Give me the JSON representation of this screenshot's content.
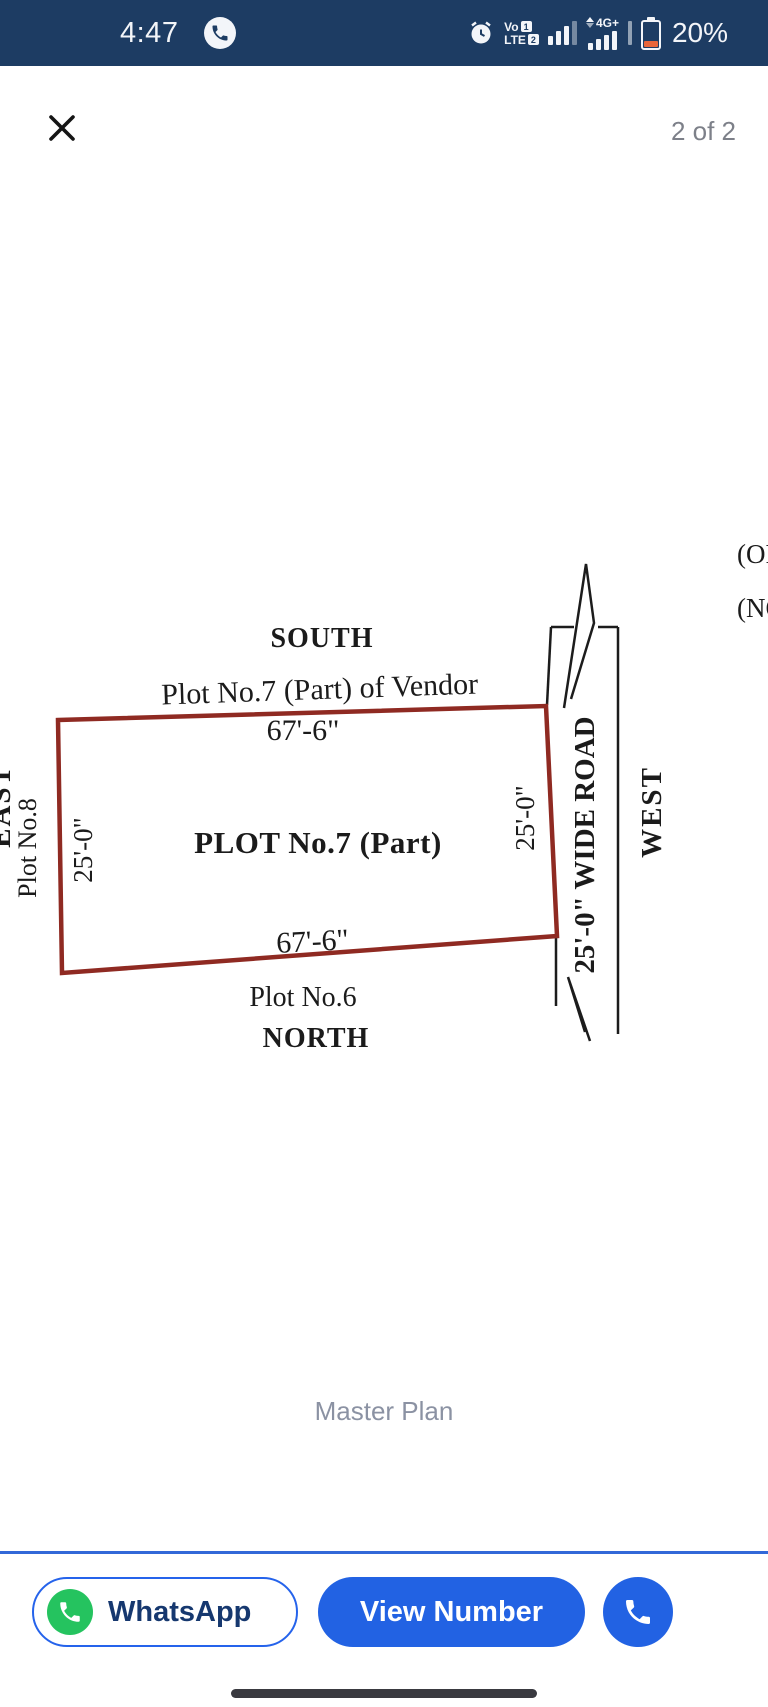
{
  "status_bar": {
    "time": "4:47",
    "battery_percent": "20%",
    "network": {
      "volte_top": "Vo",
      "volte_bottom": "LTE",
      "sim1": "1",
      "sim2": "2",
      "speed_label": "4G+"
    }
  },
  "viewer": {
    "page_indicator": "2 of 2",
    "caption": "Master Plan"
  },
  "diagram": {
    "direction_labels": {
      "south": "SOUTH",
      "north": "NORTH",
      "east": "EAST",
      "west": "WEST"
    },
    "plot": {
      "title": "PLOT No.7 (Part)",
      "top_neighbor": "Plot No.7 (Part) of Vendor",
      "bottom_neighbor": "Plot No.6",
      "left_neighbor": "Plot No.8",
      "width_top": "67'-6\"",
      "width_bottom": "67'-6\"",
      "height_left": "25'-0\"",
      "height_right": "25'-0\""
    },
    "road_label": "25'-0\" WIDE ROAD",
    "partial_text_top": "(OR",
    "partial_text_bottom": "(NO",
    "colors": {
      "plot_border": "#8f2a22",
      "line_color": "#1c1c1c"
    }
  },
  "bottom_bar": {
    "whatsapp_label": "WhatsApp",
    "view_number_label": "View Number"
  },
  "colors": {
    "status_bar_bg": "#1d3c63",
    "accent_blue": "#2262e3",
    "whatsapp_green": "#25c35f",
    "battery_low": "#e8653a",
    "caption_gray": "#8b92a3",
    "page_indicator_gray": "#7d8089"
  }
}
